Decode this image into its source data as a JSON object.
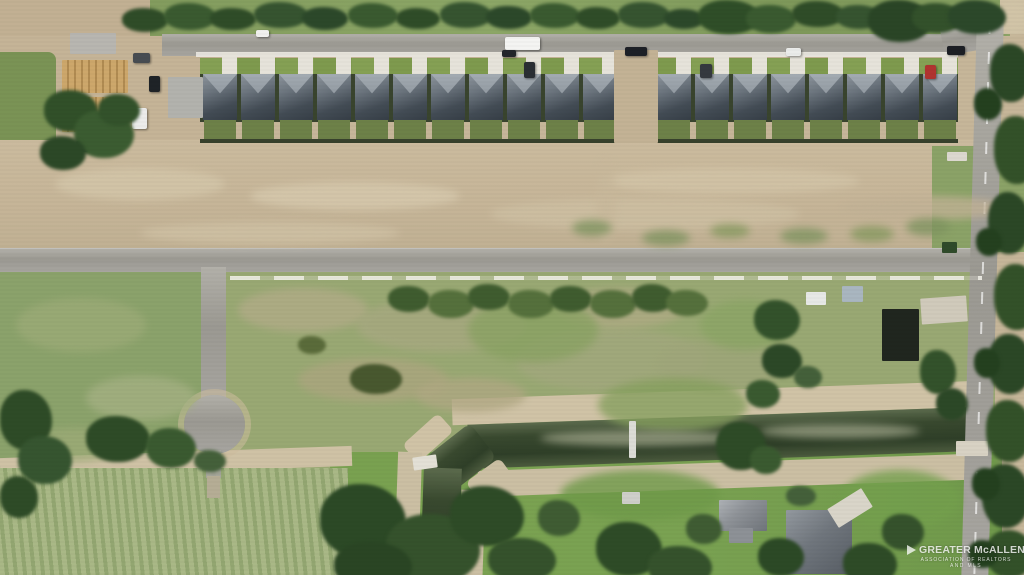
{
  "scene_label": "Aerial photo of a new-home subdivision row, vacant dirt land, cul-de-sac street, drainage canal, crop field and rural homes",
  "watermark": {
    "line1": "GREATER McALLEN",
    "line2": "ASSOCIATION OF REALTORS",
    "line3": "AND MLS"
  },
  "palette": {
    "dirt": "#c6b699",
    "dirt_light": "#d4c7aa",
    "scrub_green": "#99a873",
    "lawn_green": "#7aa252",
    "hedge_green": "#2f4c28",
    "asphalt": "#a3a19b",
    "roof_dark": "#434c55",
    "roof_light": "#98a0a8",
    "concrete": "#e6e3da",
    "canal_green": "#39492f",
    "wood_framing": "#c49f63",
    "red_car": "#b03430"
  },
  "subdivision": {
    "house_count": 19,
    "row_note": "row of identical gray hip-roof homes facing top street, one vacant dirt lot mid-row",
    "houses_x": [
      202,
      240,
      278,
      316,
      354,
      392,
      430,
      468,
      506,
      544,
      582,
      656,
      694,
      732,
      770,
      808,
      846,
      884,
      922
    ]
  },
  "scene": {
    "structures": [
      [
        614,
        50,
        44,
        93,
        "#c3b295",
        0
      ],
      [
        70,
        33,
        46,
        21,
        "#b8b6b0",
        0
      ],
      [
        168,
        77,
        35,
        41,
        "#b2b2ad",
        0
      ],
      [
        62,
        60,
        66,
        33,
        "wood",
        0
      ],
      [
        62,
        97,
        66,
        35,
        "wood",
        0
      ],
      [
        806,
        292,
        20,
        13,
        "#e7e8e6",
        0
      ],
      [
        842,
        286,
        21,
        16,
        "#a9b6c0",
        0
      ],
      [
        882,
        309,
        37,
        52,
        "#20261f",
        0
      ],
      [
        921,
        297,
        46,
        26,
        "#d0cabb",
        -4
      ],
      [
        956,
        441,
        32,
        15,
        "#d8d2c4",
        0
      ],
      [
        629,
        421,
        7,
        37,
        "#dcdcd6",
        0
      ],
      [
        413,
        456,
        24,
        13,
        "#e3e0d6",
        -8
      ],
      [
        622,
        492,
        18,
        12,
        "#cfcfca",
        0
      ],
      [
        947,
        152,
        20,
        9,
        "#dcd8cf",
        0
      ],
      [
        942,
        242,
        15,
        11,
        "#2f4a2a",
        0
      ],
      [
        719,
        500,
        48,
        31,
        "roofA",
        0
      ],
      [
        729,
        528,
        24,
        15,
        "#8d9196",
        0
      ],
      [
        786,
        510,
        66,
        64,
        "roofB",
        0
      ],
      [
        830,
        497,
        40,
        22,
        "#d9d5c9",
        -32
      ]
    ],
    "vehicles": [
      [
        133,
        53,
        17,
        10,
        "#474c52",
        0
      ],
      [
        149,
        76,
        11,
        16,
        "#1f2327",
        0
      ],
      [
        132,
        108,
        15,
        21,
        "#ececeb",
        0
      ],
      [
        76,
        141,
        13,
        11,
        "#2b3036",
        0
      ],
      [
        256,
        30,
        13,
        7,
        "#f0f0ee",
        0
      ],
      [
        505,
        37,
        35,
        13,
        "#f4f4f2",
        0
      ],
      [
        502,
        50,
        14,
        7,
        "#23262b",
        0
      ],
      [
        524,
        62,
        11,
        16,
        "#2a2e33",
        0
      ],
      [
        625,
        47,
        22,
        9,
        "#1d2026",
        0
      ],
      [
        700,
        64,
        12,
        14,
        "#35393f",
        0
      ],
      [
        786,
        48,
        15,
        8,
        "#ebecea",
        0
      ],
      [
        925,
        65,
        11,
        14,
        "#b03430",
        0
      ],
      [
        947,
        46,
        18,
        9,
        "#1c1f24",
        0
      ]
    ],
    "patches": [
      [
        55,
        168,
        170,
        32,
        "#d4c7aa"
      ],
      [
        250,
        182,
        210,
        28,
        "#d7caae"
      ],
      [
        490,
        198,
        310,
        32,
        "#cec0a3"
      ],
      [
        140,
        222,
        260,
        22,
        "#d0c2a5"
      ],
      [
        600,
        168,
        260,
        26,
        "#d3c5a8"
      ],
      [
        840,
        196,
        170,
        24,
        "#c2b296"
      ],
      [
        596,
        158,
        20,
        84,
        "#c8b89b"
      ],
      [
        1000,
        2,
        26,
        30,
        "#d2c5a8"
      ],
      [
        1002,
        420,
        22,
        70,
        "#c9bb9e"
      ],
      [
        238,
        288,
        130,
        44,
        "#b2ac88"
      ],
      [
        356,
        298,
        170,
        54,
        "#a8a981"
      ],
      [
        516,
        328,
        190,
        64,
        "#a3a87e"
      ],
      [
        298,
        358,
        150,
        44,
        "#aca67f"
      ],
      [
        556,
        288,
        130,
        40,
        "#b0ab85"
      ],
      [
        656,
        338,
        130,
        54,
        "#9fa67a"
      ],
      [
        416,
        378,
        110,
        34,
        "#b0a883"
      ],
      [
        468,
        298,
        130,
        64,
        "#8aa263"
      ],
      [
        598,
        378,
        150,
        54,
        "#87a05f"
      ],
      [
        700,
        300,
        90,
        50,
        "#8ba565"
      ],
      [
        16,
        298,
        130,
        54,
        "#9cab77"
      ],
      [
        86,
        376,
        110,
        44,
        "#a5b183"
      ],
      [
        26,
        428,
        96,
        34,
        "#9dab77"
      ],
      [
        560,
        470,
        160,
        50,
        "#6f9a49"
      ],
      [
        840,
        470,
        120,
        60,
        "#74a04d"
      ],
      [
        572,
        220,
        40,
        16,
        "#7f9460"
      ],
      [
        642,
        230,
        48,
        16,
        "#7f9460"
      ],
      [
        710,
        224,
        40,
        14,
        "#86995f"
      ],
      [
        780,
        228,
        48,
        16,
        "#7f9460"
      ],
      [
        850,
        226,
        44,
        16,
        "#86995f"
      ],
      [
        906,
        218,
        44,
        18,
        "#7f9460"
      ],
      [
        540,
        430,
        200,
        16,
        "#9aa085"
      ],
      [
        760,
        424,
        160,
        14,
        "#9aa085"
      ]
    ],
    "trees": [
      [
        122,
        8,
        46,
        24,
        "#2f4c28"
      ],
      [
        164,
        3,
        52,
        27,
        "#3a5a30"
      ],
      [
        210,
        8,
        46,
        22,
        "#2f4c28"
      ],
      [
        254,
        2,
        54,
        26,
        "#365430"
      ],
      [
        302,
        7,
        46,
        23,
        "#2c482a"
      ],
      [
        348,
        3,
        50,
        25,
        "#3a5a30"
      ],
      [
        396,
        8,
        44,
        21,
        "#2f4c28"
      ],
      [
        440,
        2,
        52,
        26,
        "#365430"
      ],
      [
        486,
        6,
        46,
        23,
        "#2c482a"
      ],
      [
        530,
        3,
        50,
        25,
        "#3a5a30"
      ],
      [
        576,
        7,
        44,
        22,
        "#2f4c28"
      ],
      [
        618,
        2,
        52,
        26,
        "#365430"
      ],
      [
        664,
        9,
        40,
        20,
        "#2c482a"
      ],
      [
        698,
        0,
        62,
        34,
        "#2f4e28"
      ],
      [
        746,
        5,
        50,
        28,
        "#3a5a30"
      ],
      [
        792,
        1,
        52,
        26,
        "#2f4c28"
      ],
      [
        836,
        5,
        46,
        24,
        "#365430"
      ],
      [
        868,
        0,
        64,
        42,
        "#2a4526"
      ],
      [
        912,
        3,
        50,
        30,
        "#33512b"
      ],
      [
        948,
        0,
        58,
        34,
        "#2c482a"
      ],
      [
        44,
        90,
        54,
        42,
        "#315029"
      ],
      [
        74,
        110,
        60,
        48,
        "#3b5c31"
      ],
      [
        40,
        136,
        46,
        34,
        "#2c4827"
      ],
      [
        98,
        94,
        42,
        32,
        "#33522b"
      ],
      [
        990,
        44,
        42,
        58,
        "#2b4726"
      ],
      [
        994,
        116,
        46,
        68,
        "#335129"
      ],
      [
        988,
        192,
        42,
        62,
        "#2b4726"
      ],
      [
        994,
        264,
        46,
        66,
        "#335129"
      ],
      [
        988,
        334,
        44,
        60,
        "#2b4726"
      ],
      [
        986,
        400,
        46,
        62,
        "#335129"
      ],
      [
        982,
        464,
        48,
        64,
        "#2b4726"
      ],
      [
        986,
        530,
        48,
        48,
        "#335129"
      ],
      [
        974,
        88,
        28,
        32,
        "#24401f"
      ],
      [
        976,
        228,
        26,
        28,
        "#24401f"
      ],
      [
        974,
        348,
        26,
        30,
        "#24401f"
      ],
      [
        972,
        468,
        28,
        32,
        "#24401f"
      ],
      [
        968,
        540,
        30,
        28,
        "#24401f"
      ],
      [
        388,
        286,
        42,
        26,
        "#3f5c2f"
      ],
      [
        428,
        290,
        46,
        28,
        "#55703c"
      ],
      [
        468,
        284,
        42,
        26,
        "#3f5c2f"
      ],
      [
        508,
        290,
        46,
        28,
        "#55703c"
      ],
      [
        550,
        286,
        42,
        26,
        "#3f5c2f"
      ],
      [
        590,
        290,
        46,
        28,
        "#55703c"
      ],
      [
        632,
        284,
        42,
        28,
        "#3f5c2f"
      ],
      [
        666,
        290,
        42,
        26,
        "#55703c"
      ],
      [
        716,
        422,
        50,
        48,
        "#2e4b27"
      ],
      [
        750,
        446,
        32,
        28,
        "#3a5a30"
      ],
      [
        0,
        390,
        52,
        60,
        "#2e4b27"
      ],
      [
        18,
        436,
        54,
        48,
        "#365530"
      ],
      [
        86,
        416,
        64,
        46,
        "#2e4b27"
      ],
      [
        146,
        428,
        50,
        40,
        "#3a5a30"
      ],
      [
        0,
        476,
        38,
        42,
        "#2e4b27"
      ],
      [
        194,
        450,
        32,
        22,
        "#44603a"
      ],
      [
        320,
        484,
        86,
        74,
        "#2c4926"
      ],
      [
        386,
        514,
        94,
        70,
        "#35522c"
      ],
      [
        450,
        486,
        74,
        60,
        "#2e4b27"
      ],
      [
        334,
        542,
        78,
        48,
        "#2a4524"
      ],
      [
        488,
        538,
        68,
        44,
        "#35522c"
      ],
      [
        538,
        500,
        42,
        36,
        "#3f5c33"
      ],
      [
        596,
        522,
        66,
        54,
        "#2e4b27"
      ],
      [
        648,
        546,
        64,
        42,
        "#35522c"
      ],
      [
        686,
        514,
        36,
        30,
        "#3f5c33"
      ],
      [
        758,
        538,
        46,
        38,
        "#2c4926"
      ],
      [
        843,
        543,
        54,
        42,
        "#2e4b27"
      ],
      [
        882,
        514,
        42,
        36,
        "#35522c"
      ],
      [
        786,
        486,
        30,
        20,
        "#44603a"
      ],
      [
        754,
        300,
        46,
        40,
        "#33522b"
      ],
      [
        762,
        344,
        40,
        34,
        "#2c4827"
      ],
      [
        746,
        380,
        34,
        28,
        "#3a5a30"
      ],
      [
        794,
        366,
        28,
        22,
        "#44603a"
      ],
      [
        920,
        350,
        36,
        44,
        "#33522b"
      ],
      [
        936,
        388,
        32,
        32,
        "#2c4827"
      ],
      [
        350,
        364,
        52,
        30,
        "#48582f"
      ],
      [
        298,
        336,
        28,
        18,
        "#5a6b3a"
      ]
    ]
  }
}
